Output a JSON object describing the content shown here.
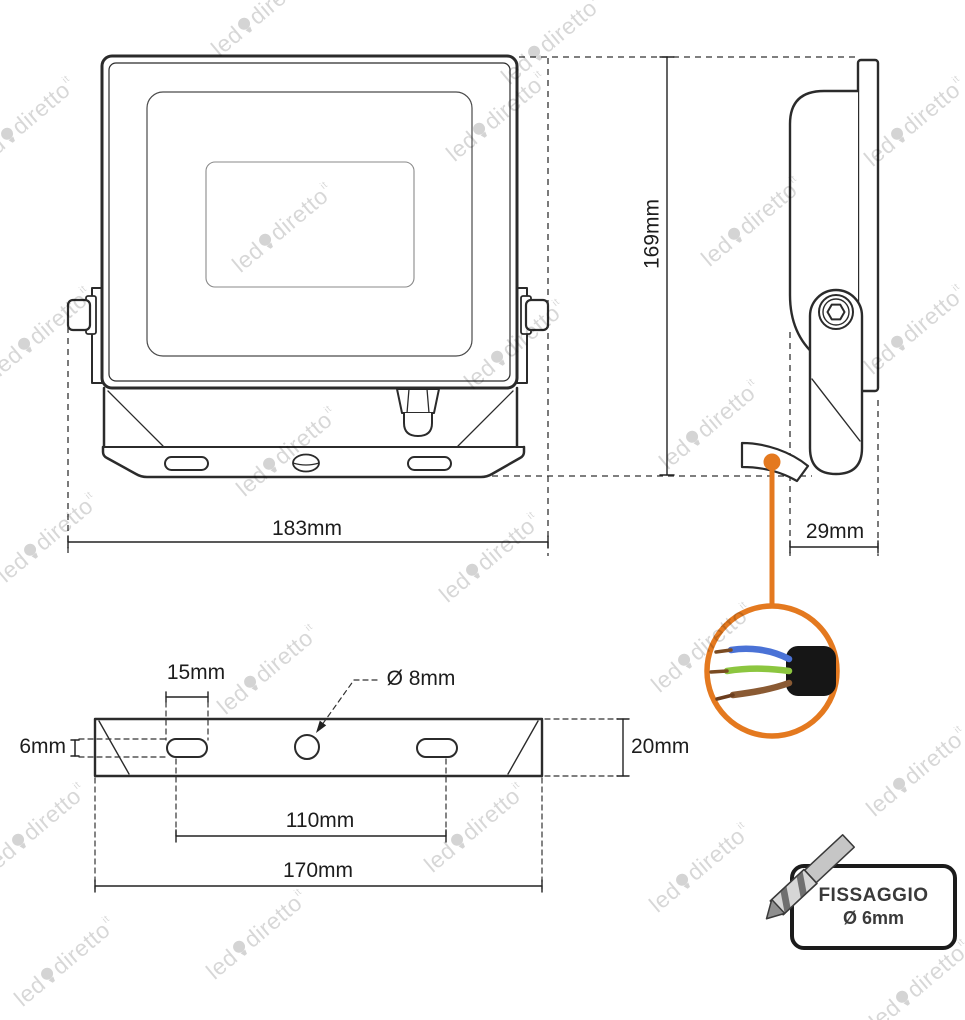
{
  "watermark": {
    "brand_first": "led",
    "brand_second": "diretto",
    "brand_tld": "it"
  },
  "dimensions": {
    "front_total_width": "183mm",
    "side_total_height": "169mm",
    "side_bracket_depth": "29mm",
    "bottom_slot_length": "15mm",
    "bottom_hole_diameter": "Ø 8mm",
    "bottom_slot_width": "6mm",
    "bottom_plate_thickness": "20mm",
    "bottom_hole_spacing": "110mm",
    "bottom_total_width": "170mm"
  },
  "fixing_callout": {
    "title": "FISSAGGIO",
    "drill_size": "Ø 6mm"
  },
  "colors": {
    "accent_orange": "#e4791f",
    "line": "#2b2b2b",
    "wire_blue": "#4a72d6",
    "wire_green": "#8cc63f",
    "wire_brown": "#8a5a33",
    "copper": "#7a4b22"
  }
}
